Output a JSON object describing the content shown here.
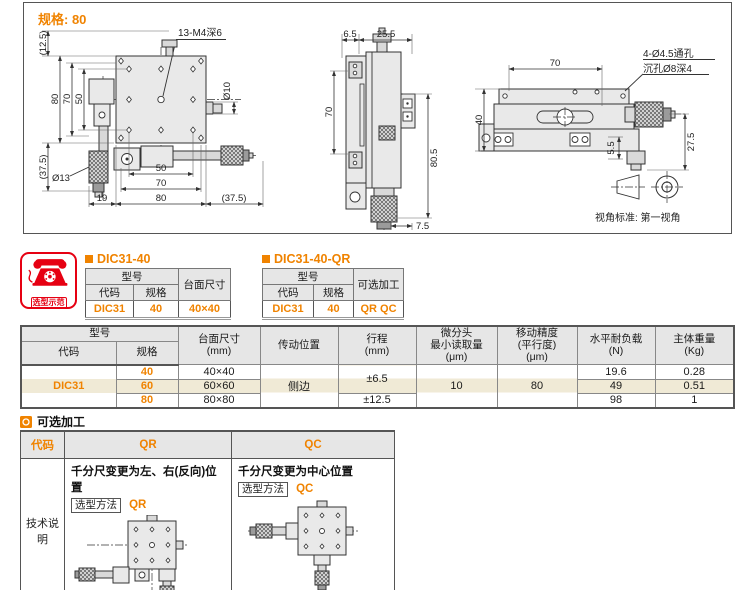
{
  "drawing_panel": {
    "spec_label": "规格: 80",
    "projection_note": "视角标准: 第一视角",
    "top_view": {
      "hole_note": "13-M4深6",
      "dia_right": "Ø10",
      "dia_knob": "Ø13",
      "dim_v_bracket": "(12.5)",
      "dim_v_80": "80",
      "dim_v_70": "70",
      "dim_v_50": "50",
      "dim_v_375": "(37.5)",
      "dim_h_50": "50",
      "dim_h_70": "70",
      "dim_h_19": "19",
      "dim_h_80": "80",
      "dim_h_375": "(37.5)"
    },
    "side_view": {
      "dim_65": "6.5",
      "dim_255": "25.5",
      "dim_70": "70",
      "dim_805": "80.5",
      "dim_75": "7.5"
    },
    "front_view": {
      "dim_70": "70",
      "dim_40": "40",
      "dim_275": "27.5",
      "dim_55": "5.5",
      "hole_note_1": "4-Ø4.5通孔",
      "hole_note_2": "沉孔Ø8深4"
    }
  },
  "selection_example": {
    "badge": "选型示范",
    "table_1": {
      "title": "DIC31-40",
      "h_model": "型号",
      "h_code": "代码",
      "h_spec": "规格",
      "h_extra": "台面尺寸",
      "v_code": "DIC31",
      "v_spec": "40",
      "v_extra": "40×40"
    },
    "table_2": {
      "title": "DIC31-40-QR",
      "h_model": "型号",
      "h_code": "代码",
      "h_spec": "规格",
      "h_extra": "可选加工",
      "v_code": "DIC31",
      "v_spec": "40",
      "v_extra": "QR QC"
    }
  },
  "spec_table": {
    "h_model": "型号",
    "h_code": "代码",
    "h_spec": "规格",
    "h_size_1": "台面尺寸",
    "h_size_2": "(mm)",
    "h_drive": "传动位置",
    "h_travel_1": "行程",
    "h_travel_2": "(mm)",
    "h_micro_1": "微分头",
    "h_micro_2": "最小读取量",
    "h_micro_3": "(μm)",
    "h_acc_1": "移动精度",
    "h_acc_2": "(平行度)",
    "h_acc_3": "(μm)",
    "h_load_1": "水平耐负载",
    "h_load_2": "(N)",
    "h_weight_1": "主体重量",
    "h_weight_2": "(Kg)",
    "code": "DIC31",
    "drive": "侧边",
    "travel_40_60": "±6.5",
    "travel_80": "±12.5",
    "micro": "10",
    "accuracy": "80",
    "rows": [
      {
        "spec": "40",
        "size": "40×40",
        "load": "19.6",
        "weight": "0.28"
      },
      {
        "spec": "60",
        "size": "60×60",
        "load": "49",
        "weight": "0.51"
      },
      {
        "spec": "80",
        "size": "80×80",
        "load": "98",
        "weight": "1"
      }
    ]
  },
  "optional": {
    "section_title": "可选加工",
    "h_code": "代码",
    "h_qr": "QR",
    "h_qc": "QC",
    "row_label": "技术说明",
    "qr_title": "千分尺变更为左、右(反向)位置",
    "qc_title": "千分尺变更为中心位置",
    "method_label": "选型方法",
    "qr_value": "QR",
    "qc_value": "QC"
  }
}
